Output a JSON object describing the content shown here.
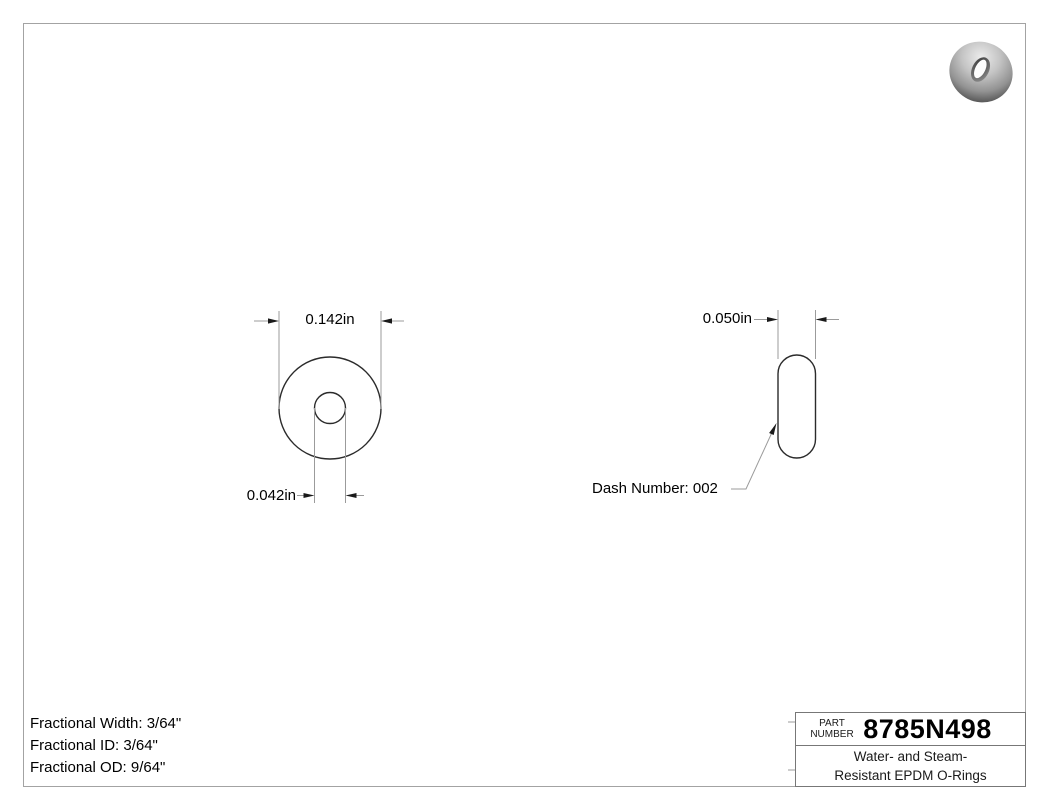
{
  "front_view": {
    "od_dimension": "0.142in",
    "id_dimension": "0.042in"
  },
  "side_view": {
    "width_dimension": "0.050in",
    "dash_label": "Dash Number: 002"
  },
  "specs": {
    "lines": [
      "Fractional Width: 3/64\"",
      "Fractional ID: 3/64\"",
      "Fractional OD: 9/64\""
    ]
  },
  "title_block": {
    "part_label_top": "PART",
    "part_label_bottom": "NUMBER",
    "part_number": "8785N498",
    "description_line1": "Water- and Steam-",
    "description_line2": "Resistant EPDM O-Rings"
  },
  "thumbnail": {
    "icon": "o-ring-torus-3d"
  },
  "colors": {
    "object_line": "#2b2b2b",
    "dimension_line": "#9b9b9b",
    "arrowhead": "#1a1a1a",
    "frame_border": "#a3a3a3",
    "text": "#000000"
  }
}
